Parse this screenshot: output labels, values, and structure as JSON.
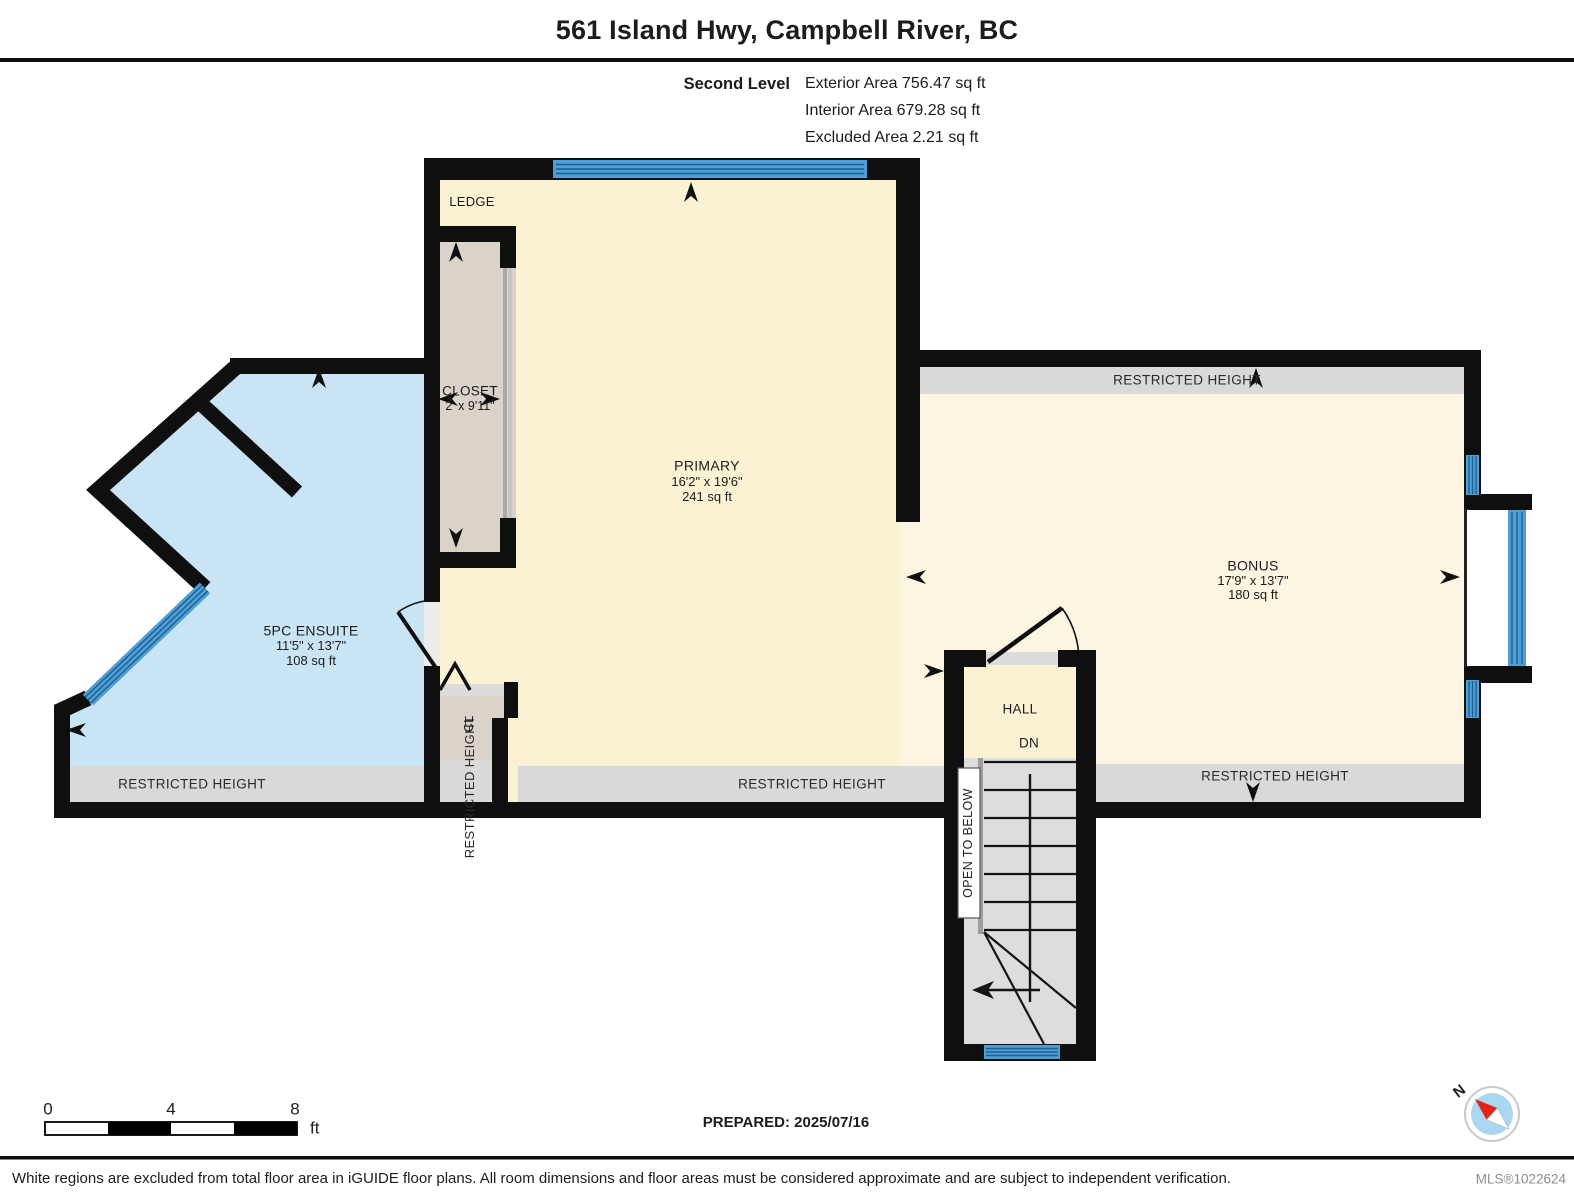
{
  "header": {
    "title": "561 Island Hwy, Campbell River, BC",
    "level": "Second Level",
    "exterior_area": "Exterior Area 756.47 sq ft",
    "interior_area": "Interior Area 679.28 sq ft",
    "excluded_area": "Excluded Area 2.21 sq ft"
  },
  "rooms": {
    "primary": {
      "name": "PRIMARY",
      "dims": "16'2\" x 19'6\"",
      "area": "241 sq ft"
    },
    "ensuite": {
      "name": "5PC ENSUITE",
      "dims": "11'5\" x 13'7\"",
      "area": "108 sq ft"
    },
    "bonus": {
      "name": "BONUS",
      "dims": "17'9\" x 13'7\"",
      "area": "180 sq ft"
    },
    "closet": {
      "name": "CLOSET",
      "dims": "2' x 9'11\""
    },
    "ledge": {
      "name": "LEDGE"
    },
    "hall": {
      "name": "HALL"
    },
    "closet_small": {
      "name": "CL"
    }
  },
  "annotations": {
    "restricted_height": "RESTRICTED HEIGHT",
    "open_to_below": "OPEN TO BELOW",
    "down": "DN",
    "north": "N"
  },
  "scale_bar": {
    "tick_0": "0",
    "tick_4": "4",
    "tick_8": "8",
    "unit": "ft"
  },
  "footer": {
    "prepared": "PREPARED: 2025/07/16",
    "disclaimer": "White regions are excluded from total floor area in iGUIDE floor plans. All room dimensions and floor areas must be considered approximate and are subject to independent verification.",
    "mls": "MLS®1022624"
  },
  "colors": {
    "wall": "#0f0f0f",
    "room_cream": "#fbf1d3",
    "bonus_cream": "#fcf5e1",
    "closet_tan": "#dad3ca",
    "ensuite_blue": "#c9e5f5",
    "window_blue": "#4d9fd6",
    "restricted_gray": "#d9d9d9",
    "stair_gray": "#dddddd"
  }
}
